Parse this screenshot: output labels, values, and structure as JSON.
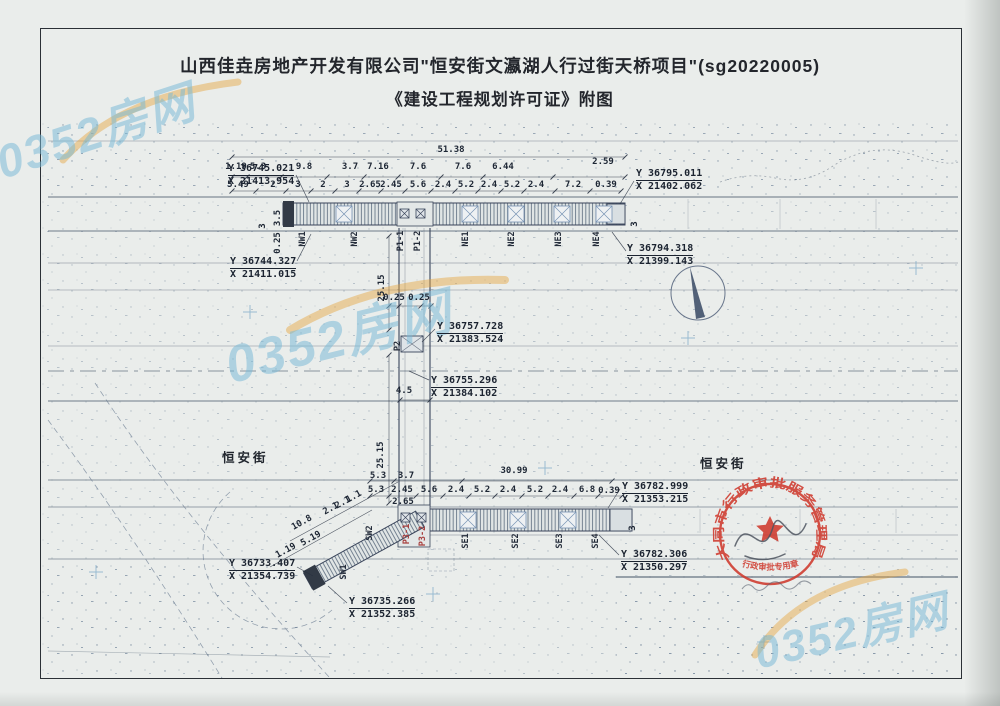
{
  "title": {
    "line1": "山西佳垚房地产开发有限公司\"恒安街文瀛湖人行过街天桥项目\"(sg20220005)",
    "line2": "《建设工程规划许可证》附图"
  },
  "watermark_text": "0352房网",
  "watermarks": [
    {
      "text": "0352房网",
      "x": -8,
      "y": 96,
      "rot": -18,
      "size": 46
    },
    {
      "text": "0352房网",
      "x": 222,
      "y": 296,
      "rot": -14,
      "size": 52
    },
    {
      "text": "0352房网",
      "x": 752,
      "y": 596,
      "rot": -13,
      "size": 44
    }
  ],
  "streets": [
    {
      "label": "恒安街",
      "x": 222,
      "y": 447
    },
    {
      "label": "恒安街",
      "x": 700,
      "y": 453
    }
  ],
  "survey_points": [
    {
      "y": "Y 36745.021",
      "x": "X 21413.954",
      "px": 228,
      "py": 163
    },
    {
      "y": "Y 36795.011",
      "x": "X 21402.062",
      "px": 636,
      "py": 168
    },
    {
      "y": "Y 36794.318",
      "x": "X 21399.143",
      "px": 627,
      "py": 243
    },
    {
      "y": "Y 36744.327",
      "x": "X 21411.015",
      "px": 230,
      "py": 256
    },
    {
      "y": "Y 36757.728",
      "x": "X 21383.524",
      "px": 437,
      "py": 321
    },
    {
      "y": "Y 36755.296",
      "x": "X 21384.102",
      "px": 431,
      "py": 375
    },
    {
      "y": "Y 36782.999",
      "x": "X 21353.215",
      "px": 622,
      "py": 481
    },
    {
      "y": "Y 36782.306",
      "x": "X 21350.297",
      "px": 621,
      "py": 549
    },
    {
      "y": "Y 36733.407",
      "x": "X 21354.739",
      "px": 229,
      "py": 558
    },
    {
      "y": "Y 36735.266",
      "x": "X 21352.385",
      "px": 349,
      "py": 596
    }
  ],
  "annotations": [
    {
      "t": "51.38",
      "x": 451,
      "y": 150
    },
    {
      "t": "1.19",
      "x": 236,
      "y": 167
    },
    {
      "t": "5.3",
      "x": 258,
      "y": 167
    },
    {
      "t": "9.8",
      "x": 304,
      "y": 167
    },
    {
      "t": "3.7",
      "x": 350,
      "y": 167
    },
    {
      "t": "7.16",
      "x": 378,
      "y": 167
    },
    {
      "t": "7.6",
      "x": 418,
      "y": 167
    },
    {
      "t": "7.6",
      "x": 463,
      "y": 167
    },
    {
      "t": "6.44",
      "x": 503,
      "y": 167
    },
    {
      "t": "2.59",
      "x": 603,
      "y": 162
    },
    {
      "t": "5.49",
      "x": 238,
      "y": 185
    },
    {
      "t": "2",
      "x": 273,
      "y": 185
    },
    {
      "t": "3",
      "x": 298,
      "y": 185
    },
    {
      "t": "2",
      "x": 323,
      "y": 185
    },
    {
      "t": "3",
      "x": 347,
      "y": 185
    },
    {
      "t": "2.65",
      "x": 370,
      "y": 185
    },
    {
      "t": "2.45",
      "x": 391,
      "y": 185
    },
    {
      "t": "5.6",
      "x": 418,
      "y": 185
    },
    {
      "t": "2.4",
      "x": 443,
      "y": 185
    },
    {
      "t": "5.2",
      "x": 466,
      "y": 185
    },
    {
      "t": "2.4",
      "x": 489,
      "y": 185
    },
    {
      "t": "5.2",
      "x": 512,
      "y": 185
    },
    {
      "t": "2.4",
      "x": 536,
      "y": 185
    },
    {
      "t": "7.2",
      "x": 573,
      "y": 185
    },
    {
      "t": "0.39",
      "x": 606,
      "y": 185
    },
    {
      "t": "3",
      "x": 263,
      "y": 226,
      "rot": -90
    },
    {
      "t": "3.5",
      "x": 278,
      "y": 218,
      "rot": -90
    },
    {
      "t": "0.25",
      "x": 278,
      "y": 243,
      "rot": -90
    },
    {
      "t": "3",
      "x": 635,
      "y": 224,
      "rot": -90
    },
    {
      "t": "25.15",
      "x": 382,
      "y": 288,
      "rot": -90
    },
    {
      "t": "0.25",
      "x": 394,
      "y": 298
    },
    {
      "t": "0.25",
      "x": 419,
      "y": 298
    },
    {
      "t": "4.5",
      "x": 404,
      "y": 391
    },
    {
      "t": "25.15",
      "x": 381,
      "y": 455,
      "rot": -90
    },
    {
      "t": "5.3",
      "x": 378,
      "y": 476
    },
    {
      "t": "3.7",
      "x": 406,
      "y": 476
    },
    {
      "t": "30.99",
      "x": 514,
      "y": 471
    },
    {
      "t": "5.3",
      "x": 376,
      "y": 490
    },
    {
      "t": "2.45",
      "x": 402,
      "y": 490
    },
    {
      "t": "5.6",
      "x": 429,
      "y": 490
    },
    {
      "t": "2.4",
      "x": 456,
      "y": 490
    },
    {
      "t": "5.2",
      "x": 482,
      "y": 490
    },
    {
      "t": "2.4",
      "x": 508,
      "y": 490
    },
    {
      "t": "5.2",
      "x": 535,
      "y": 490
    },
    {
      "t": "2.4",
      "x": 560,
      "y": 490
    },
    {
      "t": "6.8",
      "x": 587,
      "y": 490
    },
    {
      "t": "0.39",
      "x": 609,
      "y": 491
    },
    {
      "t": "2.65",
      "x": 403,
      "y": 502
    },
    {
      "t": "3",
      "x": 633,
      "y": 528,
      "rot": -90
    },
    {
      "t": "1.19",
      "x": 286,
      "y": 551,
      "rot": -29
    },
    {
      "t": "5.19",
      "x": 311,
      "y": 539,
      "rot": -29
    },
    {
      "t": "10.8",
      "x": 302,
      "y": 523,
      "rot": -29
    },
    {
      "t": "2.1",
      "x": 331,
      "y": 509,
      "rot": -29
    },
    {
      "t": "2.1",
      "x": 343,
      "y": 503,
      "rot": -29
    },
    {
      "t": "1.1",
      "x": 354,
      "y": 497,
      "rot": -29
    }
  ],
  "bridge_labels": [
    {
      "t": "NW1",
      "x": 303,
      "y": 239
    },
    {
      "t": "NW2",
      "x": 355,
      "y": 239
    },
    {
      "t": "P1-1",
      "x": 401,
      "y": 241
    },
    {
      "t": "P1-2",
      "x": 418,
      "y": 241
    },
    {
      "t": "NE1",
      "x": 466,
      "y": 239
    },
    {
      "t": "NE2",
      "x": 512,
      "y": 239
    },
    {
      "t": "NE3",
      "x": 559,
      "y": 239
    },
    {
      "t": "NE4",
      "x": 597,
      "y": 239
    },
    {
      "t": "P2",
      "x": 398,
      "y": 346
    },
    {
      "t": "P3-1",
      "x": 407,
      "y": 534,
      "red": true
    },
    {
      "t": "P3-2",
      "x": 423,
      "y": 536,
      "red": true
    },
    {
      "t": "SE1",
      "x": 466,
      "y": 541
    },
    {
      "t": "SE2",
      "x": 516,
      "y": 541
    },
    {
      "t": "SE3",
      "x": 560,
      "y": 541
    },
    {
      "t": "SE4",
      "x": 596,
      "y": 541
    },
    {
      "t": "SW1",
      "x": 344,
      "y": 572
    },
    {
      "t": "SW2",
      "x": 370,
      "y": 533
    }
  ],
  "stamp": {
    "agency": "大同市行政审批服务管理局",
    "purpose": "行政审批专用章",
    "color": "#cf3a2e"
  },
  "colors": {
    "paper": "#eaedeb",
    "ink": "#1d2634",
    "road": "#5e6c7c",
    "watermark_blue": "#76b8d6",
    "watermark_orange": "#e6a33c",
    "stamp_red": "#cf3a2e"
  }
}
